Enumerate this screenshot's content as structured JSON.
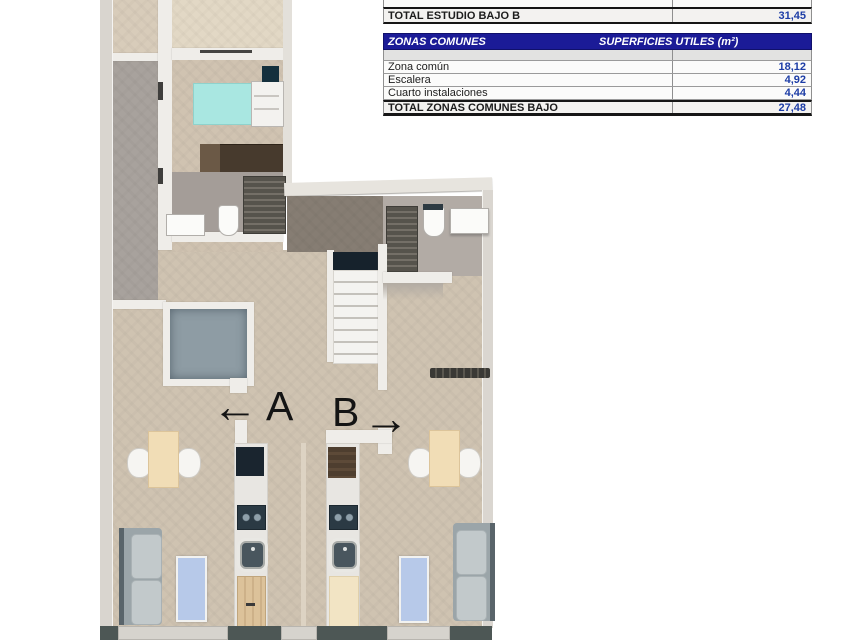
{
  "colors": {
    "table_header_bg": "#1b1b97",
    "table_value_text": "#1d3da6",
    "floor_beige": "#cfc3b1",
    "floor_gray": "#a8a19b",
    "terrace_dark": "#867d73",
    "patio_blue_gray": "#8e9ca4",
    "bed_teal": "#a9e7e1",
    "navy_dark": "#16222c",
    "rug_blue": "#b7c9e9",
    "sofa_gray": "#9ba5a9",
    "wood": "#dcc29a"
  },
  "summary_table": {
    "rows": [
      {
        "label": "TOTAL ESTUDIO BAJO B",
        "value": "31,45"
      }
    ]
  },
  "zonas_table": {
    "header": {
      "title": "ZONAS COMUNES",
      "units": "SUPERFICIES UTILES  (m²)"
    },
    "rows": [
      {
        "label": "Zona común",
        "value": "18,12"
      },
      {
        "label": "Escalera",
        "value": "4,92"
      },
      {
        "label": "Cuarto instalaciones",
        "value": "4,44"
      }
    ],
    "total": {
      "label": "TOTAL ZONAS COMUNES BAJO",
      "value": "27,48"
    }
  },
  "plan": {
    "unit_a_label": "A",
    "unit_b_label": "B",
    "arrow_left_glyph": "←",
    "arrow_right_glyph": "→"
  }
}
